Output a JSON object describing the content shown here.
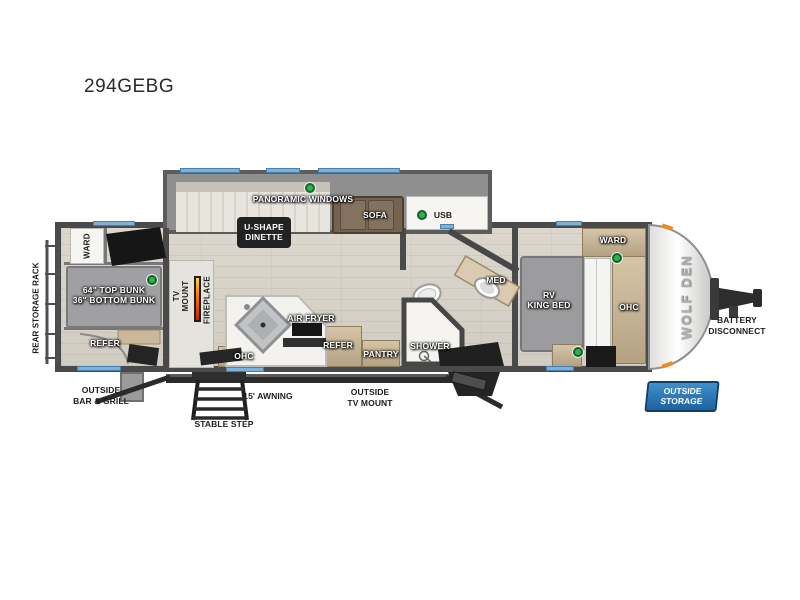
{
  "title": "294GEBG",
  "legend": {
    "usb": "USB"
  },
  "colors": {
    "window_blue": "#7ab2dc",
    "usb_green": "#2fb34a",
    "wall_gray": "#4a4a4a",
    "slide_gray": "#8f8f8f",
    "cabinet_tan": "#c9b89a",
    "storage_badge_blue": "#1d629e",
    "fireplace_orange": "#f08a1d"
  },
  "exterior": {
    "rear_storage_rack": "REAR STORAGE RACK",
    "outside_bar_grill_line1": "OUTSIDE",
    "outside_bar_grill_line2": "BAR & GRILL",
    "stable_step": "STABLE STEP",
    "awning": "15' AWNING",
    "outside_tv_mount_line1": "OUTSIDE",
    "outside_tv_mount_line2": "TV MOUNT",
    "battery_disconnect_line1": "BATTERY",
    "battery_disconnect_line2": "DISCONNECT",
    "outside_storage_line1": "OUTSIDE",
    "outside_storage_line2": "STORAGE",
    "brand_logo": "WOLF DEN"
  },
  "bunk_room": {
    "ward": "WARD",
    "bunk_line1": "64\" TOP BUNK",
    "bunk_line2": "36\" BOTTOM BUNK",
    "refer": "REFER"
  },
  "living": {
    "tv_mount_line1": "TV",
    "tv_mount_line2": "MOUNT",
    "fireplace": "FIREPLACE",
    "panoramic_windows": "PANORAMIC WINDOWS",
    "dinette_line1": "U-SHAPE",
    "dinette_line2": "DINETTE",
    "sofa": "SOFA"
  },
  "kitchen": {
    "air_fryer": "AIR FRYER",
    "ohc": "OHC",
    "refer": "REFER",
    "pantry": "PANTRY"
  },
  "bath": {
    "shower": "SHOWER",
    "med": "MED"
  },
  "bedroom": {
    "bed_line1": "RV",
    "bed_line2": "KING BED",
    "ward": "WARD",
    "ohc": "OHC"
  }
}
